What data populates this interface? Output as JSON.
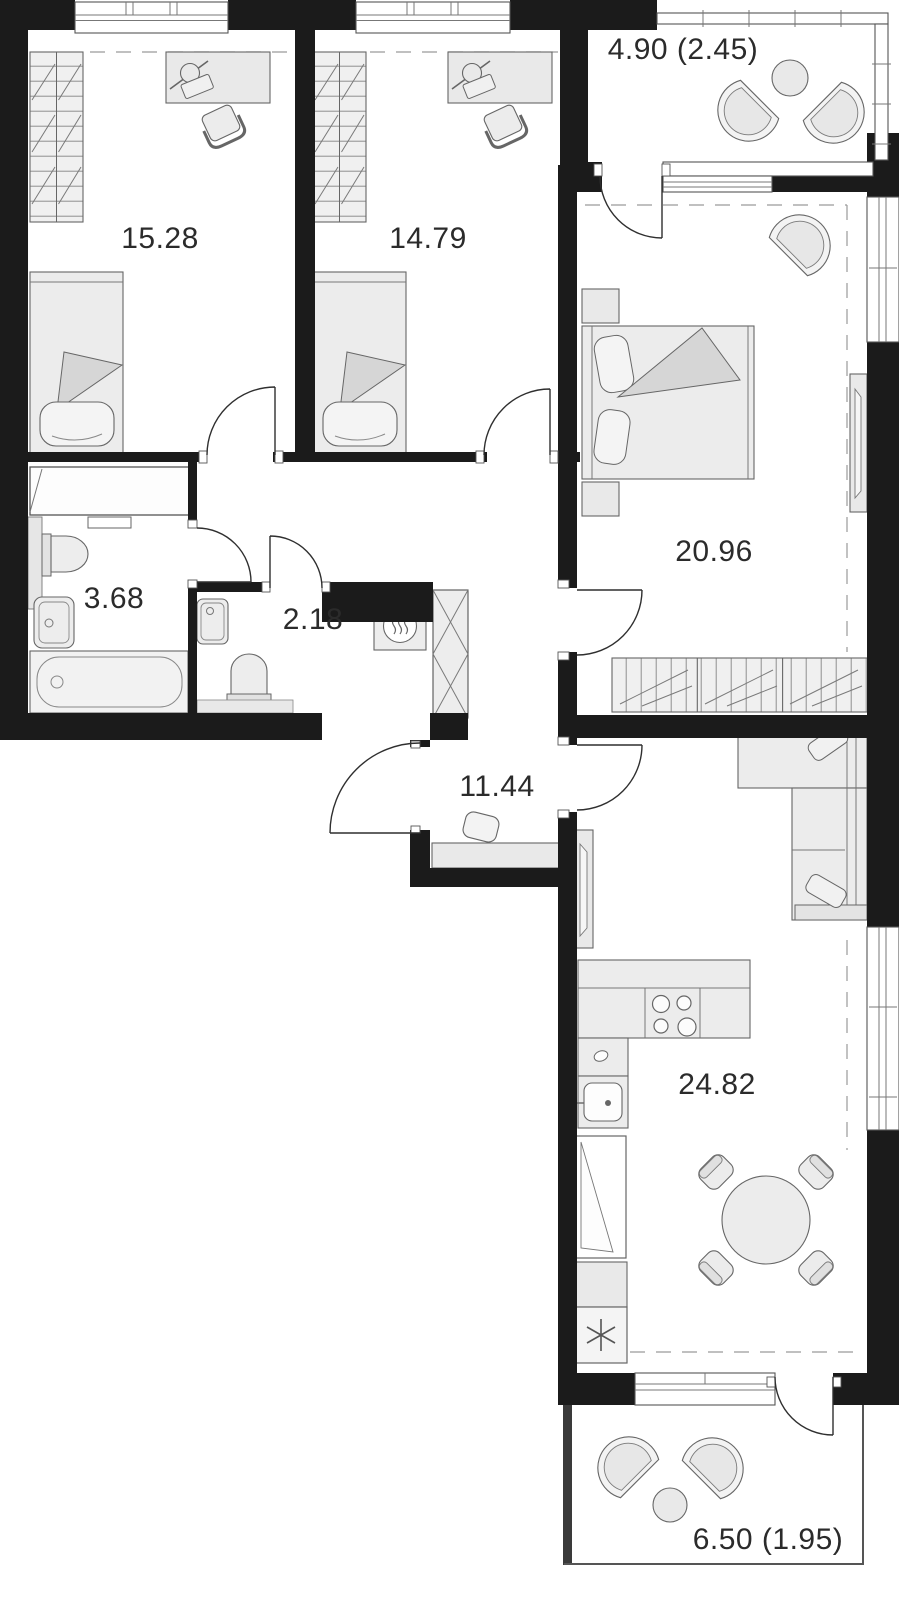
{
  "rooms": {
    "bedroom1": {
      "area": "15.28"
    },
    "bedroom2": {
      "area": "14.79"
    },
    "balcony_top": {
      "area": "4.90 (2.45)"
    },
    "master_bedroom": {
      "area": "20.96"
    },
    "bathroom": {
      "area": "3.68"
    },
    "wc": {
      "area": "2.18"
    },
    "hallway": {
      "area": "11.44"
    },
    "kitchen_living": {
      "area": "24.82"
    },
    "balcony_bottom": {
      "area": "6.50 (1.95)"
    }
  },
  "icons": {
    "fridge": "snowflake-icon",
    "water_heater": "heat-waves-icon",
    "vent_shaft": "cross-box-icon"
  },
  "colors": {
    "wall": "#1b1b1b",
    "furniture_fill": "#e9e9e9",
    "furniture_stroke": "#666666",
    "label_text": "#2b2b2b"
  }
}
